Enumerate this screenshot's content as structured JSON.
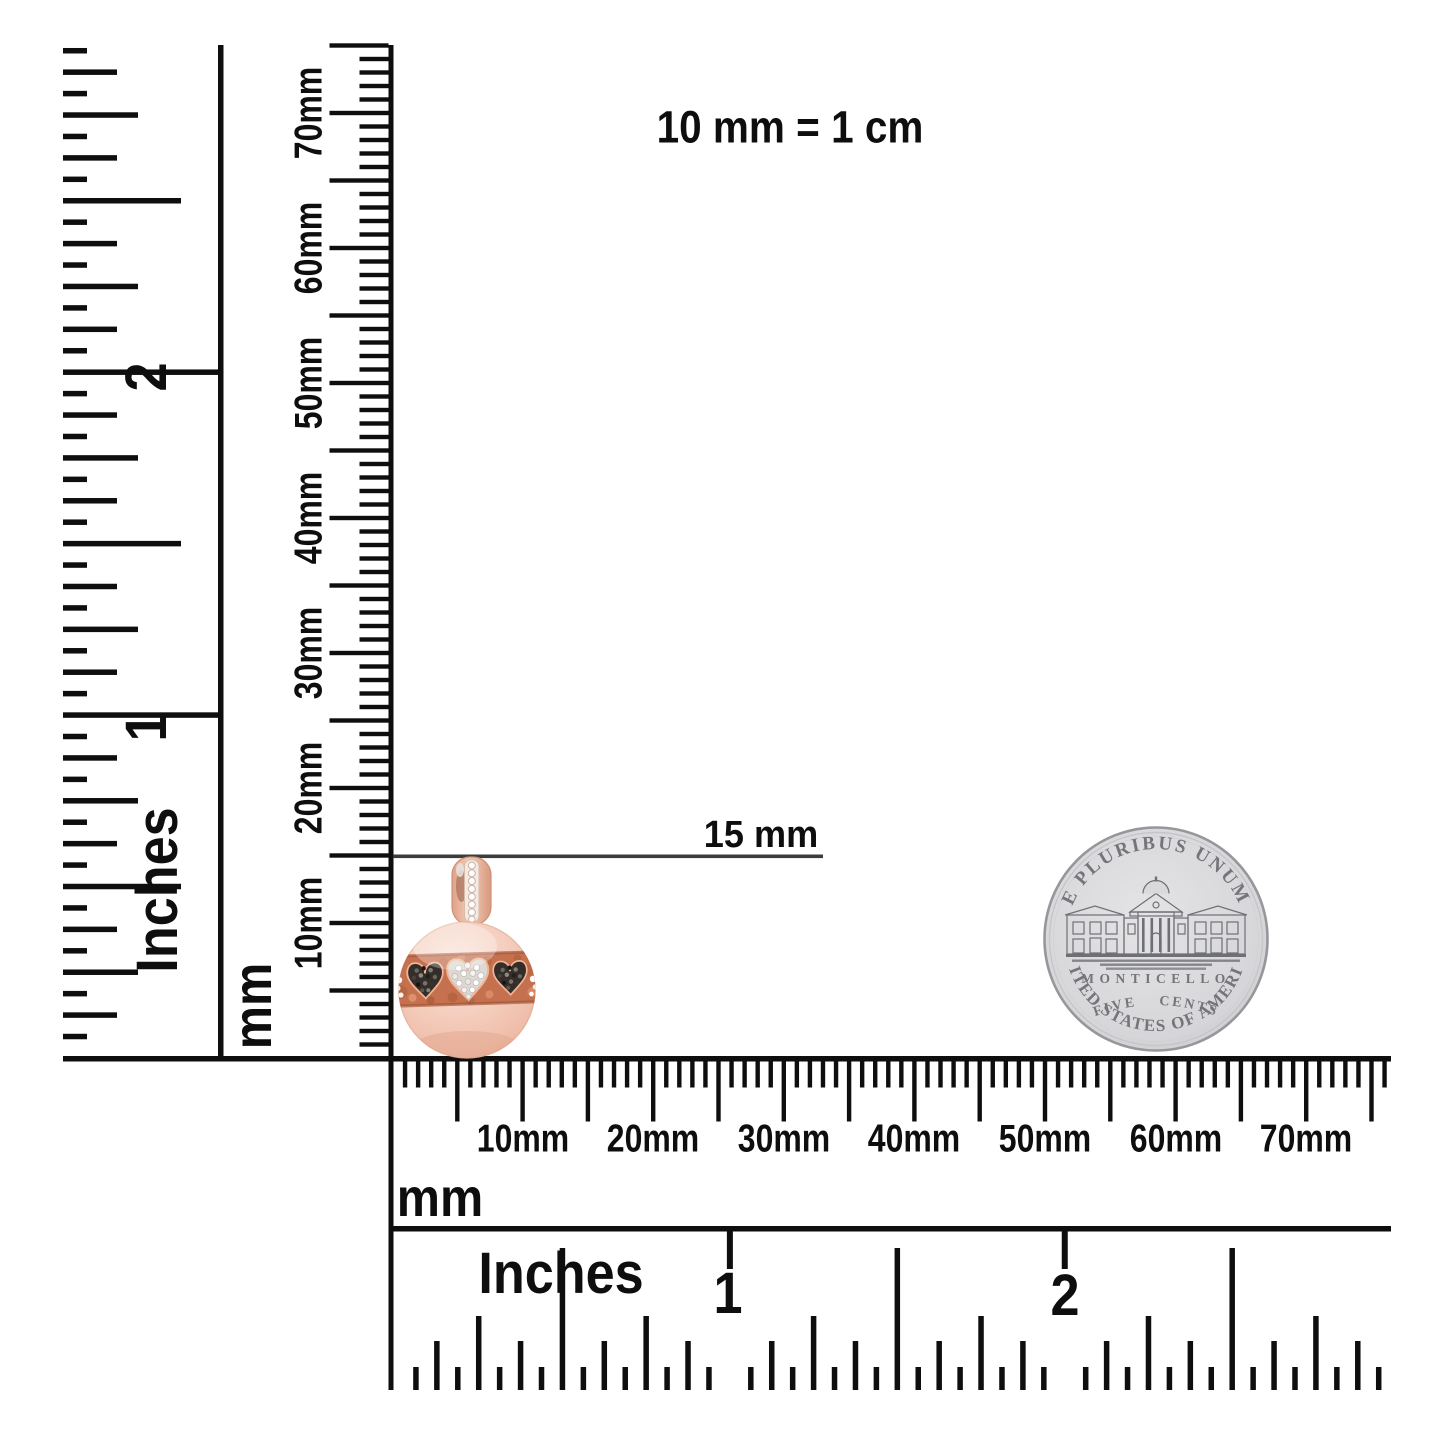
{
  "annotations": {
    "scale_note": "10 mm = 1 cm",
    "measurement_label": "15 mm"
  },
  "rulers": {
    "left_inches": {
      "unit": "Inches",
      "numbers": [
        "2",
        "1"
      ]
    },
    "left_mm": {
      "unit": "mm",
      "labels": [
        "10mm",
        "20mm",
        "30mm",
        "40mm",
        "50mm",
        "60mm",
        "70mm"
      ]
    },
    "bottom_mm": {
      "unit": "mm",
      "labels": [
        "10mm",
        "20mm",
        "30mm",
        "40mm",
        "50mm",
        "60mm",
        "70mm"
      ]
    },
    "bottom_inches": {
      "unit": "Inches",
      "numbers": [
        "1",
        "2"
      ]
    }
  },
  "coin": {
    "top_legend": "E PLURIBUS UNUM",
    "building_name": "MONTICELLO",
    "denomination": "FIVE CENTS",
    "bottom_legend": "UNITED STATES OF AMERICA"
  },
  "colors": {
    "ink": "#0e0e0e",
    "rose_gold": "#f2c4b0",
    "band_rose": "#c7714e",
    "black_diamond": "#332e29",
    "white_diamond": "#f5f2ef",
    "coin_silver": "#d6d6d9"
  }
}
